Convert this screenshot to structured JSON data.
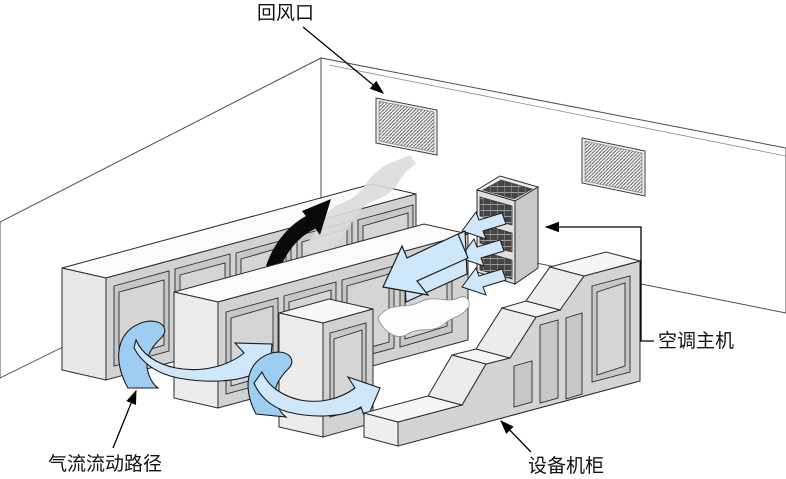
{
  "diagram": {
    "type": "isometric-airflow-schematic",
    "labels": {
      "return_air_vent": "回风口",
      "ac_main_unit": "空调主机",
      "airflow_path": "气流流动路径",
      "equipment_cabinet": "设备机柜"
    },
    "colors": {
      "background": "#ffffff",
      "airflow_blue": "#cfe7fa",
      "airflow_blue_shade": "#9dcdf0",
      "hot_air_arrow": "#0a0a0a",
      "smoke_plume_gray": "#dcdcdc",
      "cabinet_front_gray": "#d2d2d2",
      "cabinet_top_white": "#f8f8f8",
      "outline": "#2a2a2a"
    }
  }
}
